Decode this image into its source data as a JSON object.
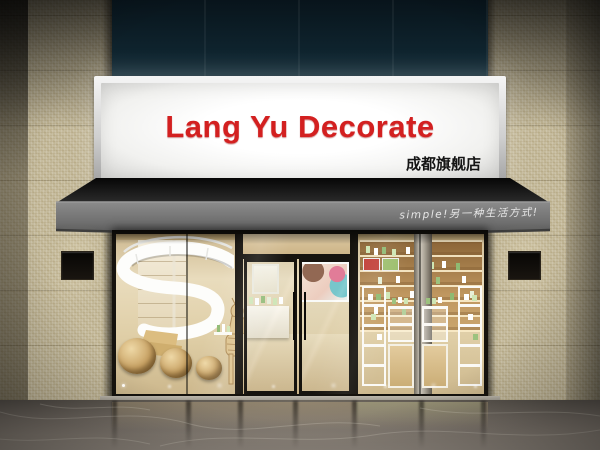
{
  "scene": {
    "type": "storefront-3d-render",
    "description": "Cosmetics shop facade with backlit signboard, gray awning, mosaic pillars and glass storefront"
  },
  "signage": {
    "title": "Lang Yu Decorate",
    "subtitle": "成都旗舰店",
    "awning_slogan": "simple!另一种生活方式!"
  },
  "colors": {
    "sign_text": "#d32020",
    "sign_face": "#f1f1ef",
    "upper_facade": "#0e222c",
    "pillar_tile": "#c6bc9e",
    "frame_black": "#16130e",
    "interior_warm": "#e9dcbd",
    "awning_valance": "#787878",
    "awning_top": "#0d0d0d",
    "floor_base": "#6e6760"
  }
}
